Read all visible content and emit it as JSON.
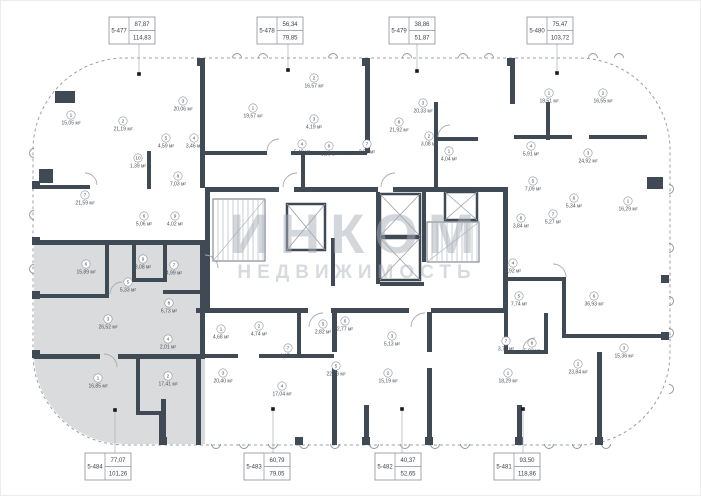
{
  "plan": {
    "watermark": {
      "line1": "ИНКОМ",
      "line2": "НЕДВИЖИМОСТЬ"
    },
    "highlighted_unit": "5-484",
    "colors": {
      "wall": "#3f4a55",
      "highlight": "#dadbdc",
      "watermark": "#a8aeb8",
      "thin_line": "#9aa0a8",
      "label_text": "#4a4f56"
    },
    "units": [
      {
        "id": "5-477",
        "area_top": "87,87",
        "area_bottom": "114,83",
        "side": "top"
      },
      {
        "id": "5-478",
        "area_top": "56,34",
        "area_bottom": "79,85",
        "side": "top"
      },
      {
        "id": "5-479",
        "area_top": "38,86",
        "area_bottom": "51,87",
        "side": "top"
      },
      {
        "id": "5-480",
        "area_top": "75,47",
        "area_bottom": "103,72",
        "side": "top"
      },
      {
        "id": "5-484",
        "area_top": "77,07",
        "area_bottom": "101,26",
        "side": "bottom"
      },
      {
        "id": "5-483",
        "area_top": "60,79",
        "area_bottom": "79,05",
        "side": "bottom"
      },
      {
        "id": "5-482",
        "area_top": "40,37",
        "area_bottom": "52,65",
        "side": "bottom"
      },
      {
        "id": "5-481",
        "area_top": "93,50",
        "area_bottom": "118,86",
        "side": "bottom"
      }
    ],
    "rooms": [
      {
        "n": "1",
        "area": "15,05 м²",
        "x": 70,
        "y": 120
      },
      {
        "n": "2",
        "area": "21,19 м²",
        "x": 122,
        "y": 126
      },
      {
        "n": "3",
        "area": "20,06 м²",
        "x": 182,
        "y": 106
      },
      {
        "n": "5",
        "area": "4,59 м²",
        "x": 165,
        "y": 143
      },
      {
        "n": "4",
        "area": "3,46 м²",
        "x": 193,
        "y": 143
      },
      {
        "n": "10",
        "area": "1,39 м²",
        "x": 137,
        "y": 163
      },
      {
        "n": "8",
        "area": "7,03 м²",
        "x": 177,
        "y": 181
      },
      {
        "n": "7",
        "area": "21,59 м²",
        "x": 84,
        "y": 200
      },
      {
        "n": "6",
        "area": "5,06 м²",
        "x": 143,
        "y": 221
      },
      {
        "n": "9",
        "area": "4,02 м²",
        "x": 174,
        "y": 221
      },
      {
        "n": "1",
        "area": "19,57 м²",
        "x": 252,
        "y": 113
      },
      {
        "n": "2",
        "area": "16,57 м²",
        "x": 313,
        "y": 83
      },
      {
        "n": "3",
        "area": "4,19 м²",
        "x": 313,
        "y": 124
      },
      {
        "n": "4",
        "area": "5,48 м²",
        "x": 301,
        "y": 149
      },
      {
        "n": "6",
        "area": "3,85 м²",
        "x": 328,
        "y": 151
      },
      {
        "n": "7",
        "area": "2,92 м²",
        "x": 366,
        "y": 149
      },
      {
        "n": "8",
        "area": "21,92 м²",
        "x": 398,
        "y": 127
      },
      {
        "n": "3",
        "area": "20,33 м²",
        "x": 422,
        "y": 108
      },
      {
        "n": "2",
        "area": "3,08 м²",
        "x": 428,
        "y": 141
      },
      {
        "n": "1",
        "area": "4,04 м²",
        "x": 448,
        "y": 156
      },
      {
        "n": "1",
        "area": "18,51 м²",
        "x": 548,
        "y": 98
      },
      {
        "n": "2",
        "area": "16,55 м²",
        "x": 602,
        "y": 98
      },
      {
        "n": "3",
        "area": "24,92 м²",
        "x": 587,
        "y": 158
      },
      {
        "n": "4",
        "area": "5,91 м²",
        "x": 530,
        "y": 151
      },
      {
        "n": "5",
        "area": "7,09 м²",
        "x": 532,
        "y": 186
      },
      {
        "n": "6",
        "area": "5,34 м²",
        "x": 573,
        "y": 203
      },
      {
        "n": "7",
        "area": "5,27 м²",
        "x": 552,
        "y": 219
      },
      {
        "n": "8",
        "area": "3,84 м²",
        "x": 520,
        "y": 223
      },
      {
        "n": "4",
        "area": "4,92 м²",
        "x": 512,
        "y": 268
      },
      {
        "n": "1",
        "area": "16,29 м²",
        "x": 627,
        "y": 206
      },
      {
        "n": "5",
        "area": "7,74 м²",
        "x": 518,
        "y": 301
      },
      {
        "n": "6",
        "area": "36,93 м²",
        "x": 593,
        "y": 301
      },
      {
        "n": "7",
        "area": "3,74 м²",
        "x": 505,
        "y": 346
      },
      {
        "n": "8",
        "area": "5,03 м²",
        "x": 531,
        "y": 348
      },
      {
        "n": "2",
        "area": "23,84 м²",
        "x": 577,
        "y": 369
      },
      {
        "n": "3",
        "area": "15,36 м²",
        "x": 623,
        "y": 353
      },
      {
        "n": "1",
        "area": "18,29 м²",
        "x": 507,
        "y": 378
      },
      {
        "n": "5",
        "area": "2,82 м²",
        "x": 322,
        "y": 329
      },
      {
        "n": "6",
        "area": "2,77 м²",
        "x": 344,
        "y": 326
      },
      {
        "n": "5",
        "area": "22,76 м²",
        "x": 335,
        "y": 371
      },
      {
        "n": "3",
        "area": "5,13 м²",
        "x": 391,
        "y": 341
      },
      {
        "n": "2",
        "area": "15,19 м²",
        "x": 387,
        "y": 378
      },
      {
        "n": "1",
        "area": "4,68 м²",
        "x": 220,
        "y": 334
      },
      {
        "n": "2",
        "area": "4,74 м²",
        "x": 258,
        "y": 331
      },
      {
        "n": "7",
        "area": "4,17 м²",
        "x": 287,
        "y": 353
      },
      {
        "n": "3",
        "area": "20,40 м²",
        "x": 222,
        "y": 378
      },
      {
        "n": "4",
        "area": "17,04 м²",
        "x": 281,
        "y": 391
      },
      {
        "n": "6",
        "area": "15,89 м²",
        "x": 85,
        "y": 269
      },
      {
        "n": "9",
        "area": "3,08 м²",
        "x": 142,
        "y": 264
      },
      {
        "n": "5",
        "area": "5,33 м²",
        "x": 127,
        "y": 287
      },
      {
        "n": "7",
        "area": "4,99 м²",
        "x": 173,
        "y": 270
      },
      {
        "n": "8",
        "area": "6,73 м²",
        "x": 168,
        "y": 308
      },
      {
        "n": "3",
        "area": "26,52 м²",
        "x": 107,
        "y": 324
      },
      {
        "n": "4",
        "area": "2,01 м²",
        "x": 167,
        "y": 344
      },
      {
        "n": "1",
        "area": "16,85 м²",
        "x": 97,
        "y": 383
      },
      {
        "n": "2",
        "area": "17,41 м²",
        "x": 167,
        "y": 381
      }
    ]
  }
}
